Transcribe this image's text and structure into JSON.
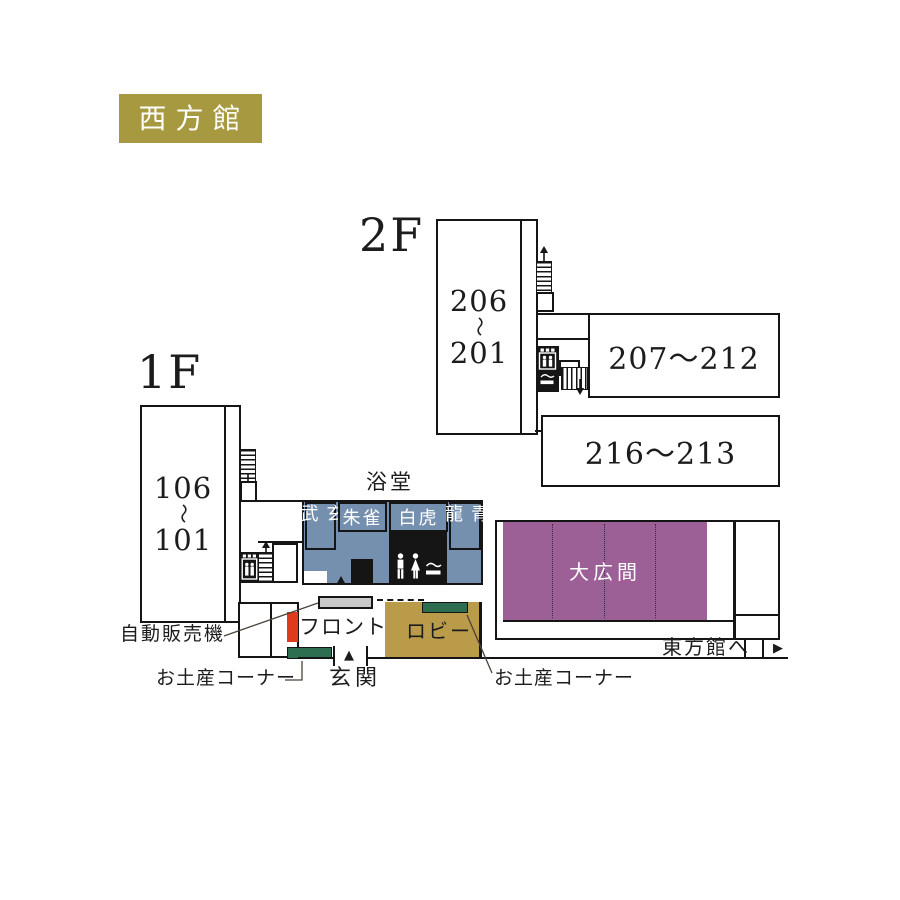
{
  "badge": {
    "label": "西方館"
  },
  "floor2": {
    "label": "2F",
    "block_left": {
      "line1": "206",
      "tilde": "〜",
      "line2": "201"
    },
    "block_right_top": {
      "label": "207〜212"
    },
    "block_right_bottom": {
      "label": "216〜213"
    }
  },
  "floor1": {
    "label": "1F",
    "block_left": {
      "line1": "106",
      "tilde": "〜",
      "line2": "101"
    }
  },
  "bath": {
    "title": "浴堂",
    "rooms": [
      {
        "name": "玄武"
      },
      {
        "name": "朱雀"
      },
      {
        "name": "白虎"
      },
      {
        "name": "青龍"
      }
    ]
  },
  "hall": {
    "label": "大広間"
  },
  "lobby": {
    "label": "ロビー"
  },
  "front": {
    "label": "フロント"
  },
  "vending": {
    "label": "自動販売機"
  },
  "souvenir": {
    "label_left": "お土産コーナー",
    "label_right": "お土産コーナー"
  },
  "entrance": {
    "label": "玄関",
    "arrow": "▲"
  },
  "east": {
    "label": "東方館へ",
    "arrow": "▶"
  },
  "icons": {
    "stairs_up": "↑",
    "stairs_down": "↓",
    "elevator": "elevator-pictogram",
    "toilet": "man-woman-pictogram",
    "smoking": "smoking-pictogram"
  },
  "colors": {
    "badge_gold": "#a7993f",
    "lobby_gold": "#ba9b49",
    "bath_blue": "#7590ae",
    "hall_purple": "#9c6097",
    "souvenir_green": "#2e6e50",
    "front_red": "#df3a1e",
    "vending_gray": "#c9c9c9",
    "wall_black": "#151515"
  }
}
